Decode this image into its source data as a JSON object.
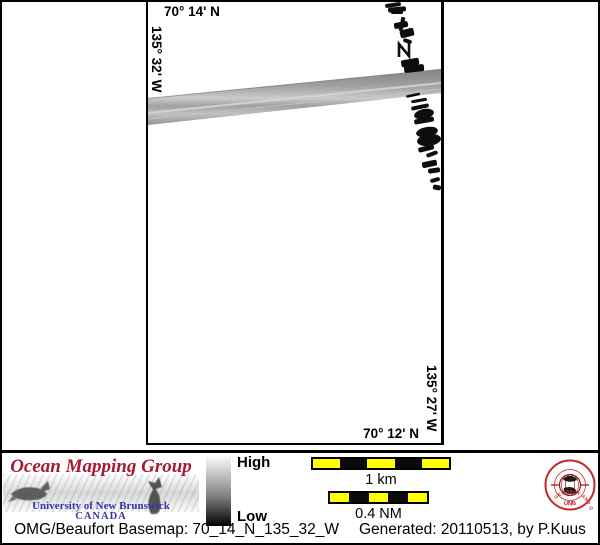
{
  "map": {
    "top_lat": "70° 14' N",
    "left_lon": "135° 32' W",
    "bottom_lat": "70° 12' N",
    "right_lon": "135° 27' W"
  },
  "legend": {
    "colorbar_high": "High",
    "colorbar_low": "Low",
    "colorbar_top_color": "#ffffff",
    "colorbar_bottom_color": "#000000",
    "scalebar_km_label": "1 km",
    "scalebar_nm_label": "0.4 NM",
    "scalebar_yellow": "#ffff00",
    "scalebar_black": "#0a0a0a"
  },
  "branding": {
    "title": "Ocean Mapping Group",
    "university": "University of New Brunswick",
    "country": "CANADA",
    "title_color": "#a81a30",
    "text_color": "#3333aa",
    "seal_ring_text": "GEODESY AND GEOMATICS ENGINEERING",
    "seal_bottom_text": "UNB",
    "seal_color": "#c62828"
  },
  "footer": {
    "basemap": "OMG/Beaufort Basemap: 70_14_N_135_32_W",
    "generated": "Generated: 20110513, by P.Kuus"
  }
}
